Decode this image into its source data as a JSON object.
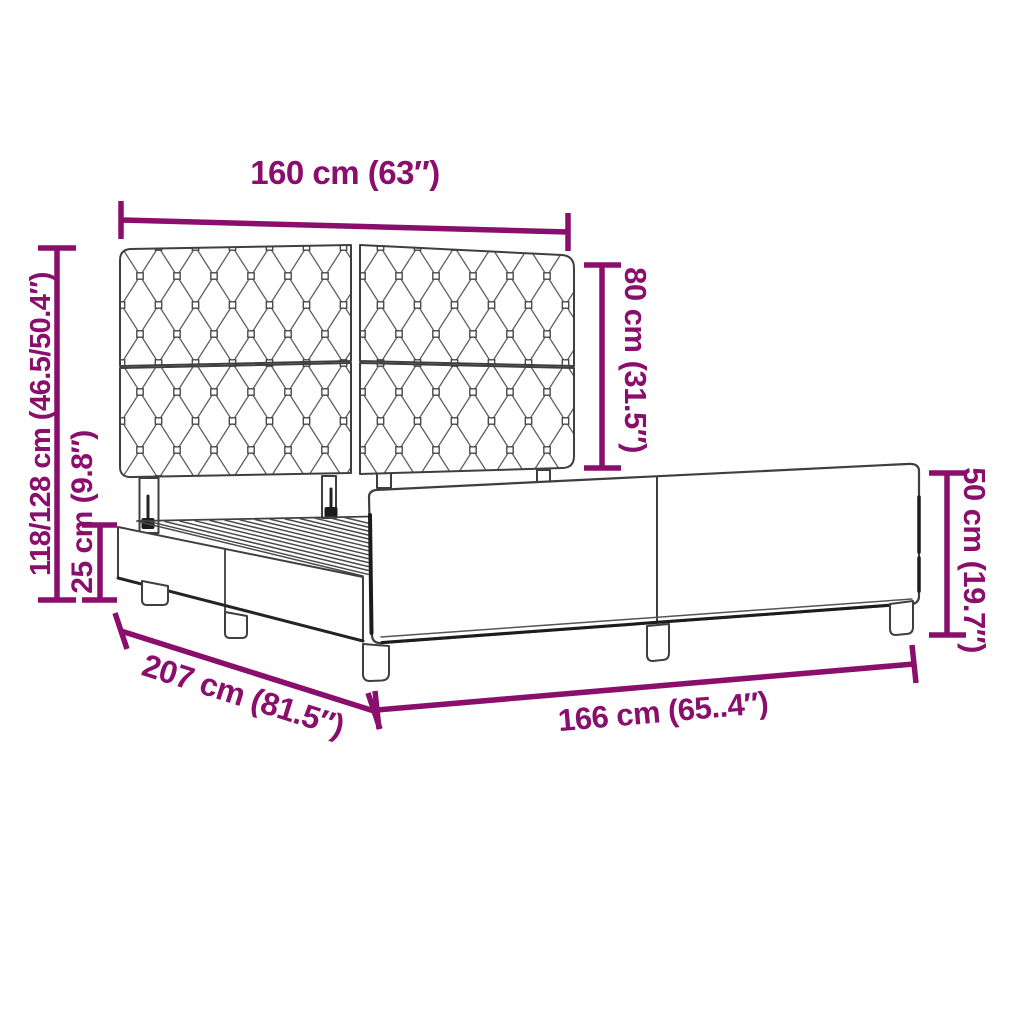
{
  "page": {
    "background": "#FFFFFF"
  },
  "diagram": {
    "kind": "bed-frame-dimension-diagram",
    "subject": "upholstered bed frame with diamond-tufted headboard, slatted base and footboard",
    "accent_color": "#8A0E6B",
    "outline_color": "#3F3F3F",
    "labels": {
      "headboard_width": "160 cm (63″)",
      "total_height": "118/128 cm (46.5/50.4″)",
      "base_height": "25 cm (9.8″)",
      "headboard_height": "80 cm (31.5″)",
      "footboard_height": "50 cm (19.7″)",
      "frame_length": "207 cm (81.5″)",
      "frame_width": "166 cm (65..4″)"
    }
  }
}
